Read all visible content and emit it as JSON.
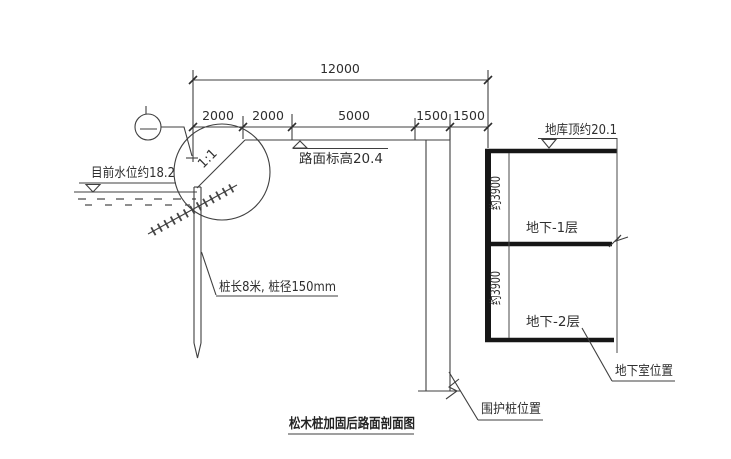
{
  "page": {
    "background": "#ffffff"
  },
  "drawing": {
    "title": "松木桩加固后路面剖面图",
    "dimensions": {
      "total": "12000",
      "segments": [
        "2000",
        "2000",
        "5000",
        "1500",
        "1500"
      ]
    },
    "labels": {
      "water_level": "目前水位约18.2",
      "road_elevation": "路面标高20.4",
      "slope_ratio": "1:1",
      "pile_note": "桩长8米, 桩径150mm",
      "garage_top": "地库顶约20.1",
      "floor_minus1": "地下-1层",
      "floor_minus2": "地下-2层",
      "floor_heights": [
        "约3900",
        "约3900"
      ],
      "basement_position": "地下室位置",
      "retaining_pile_position": "围护桩位置"
    },
    "colors": {
      "line": "#3f3f3f",
      "thick_line": "#161616",
      "text": "#2e2e2e",
      "background": "#ffffff"
    }
  }
}
